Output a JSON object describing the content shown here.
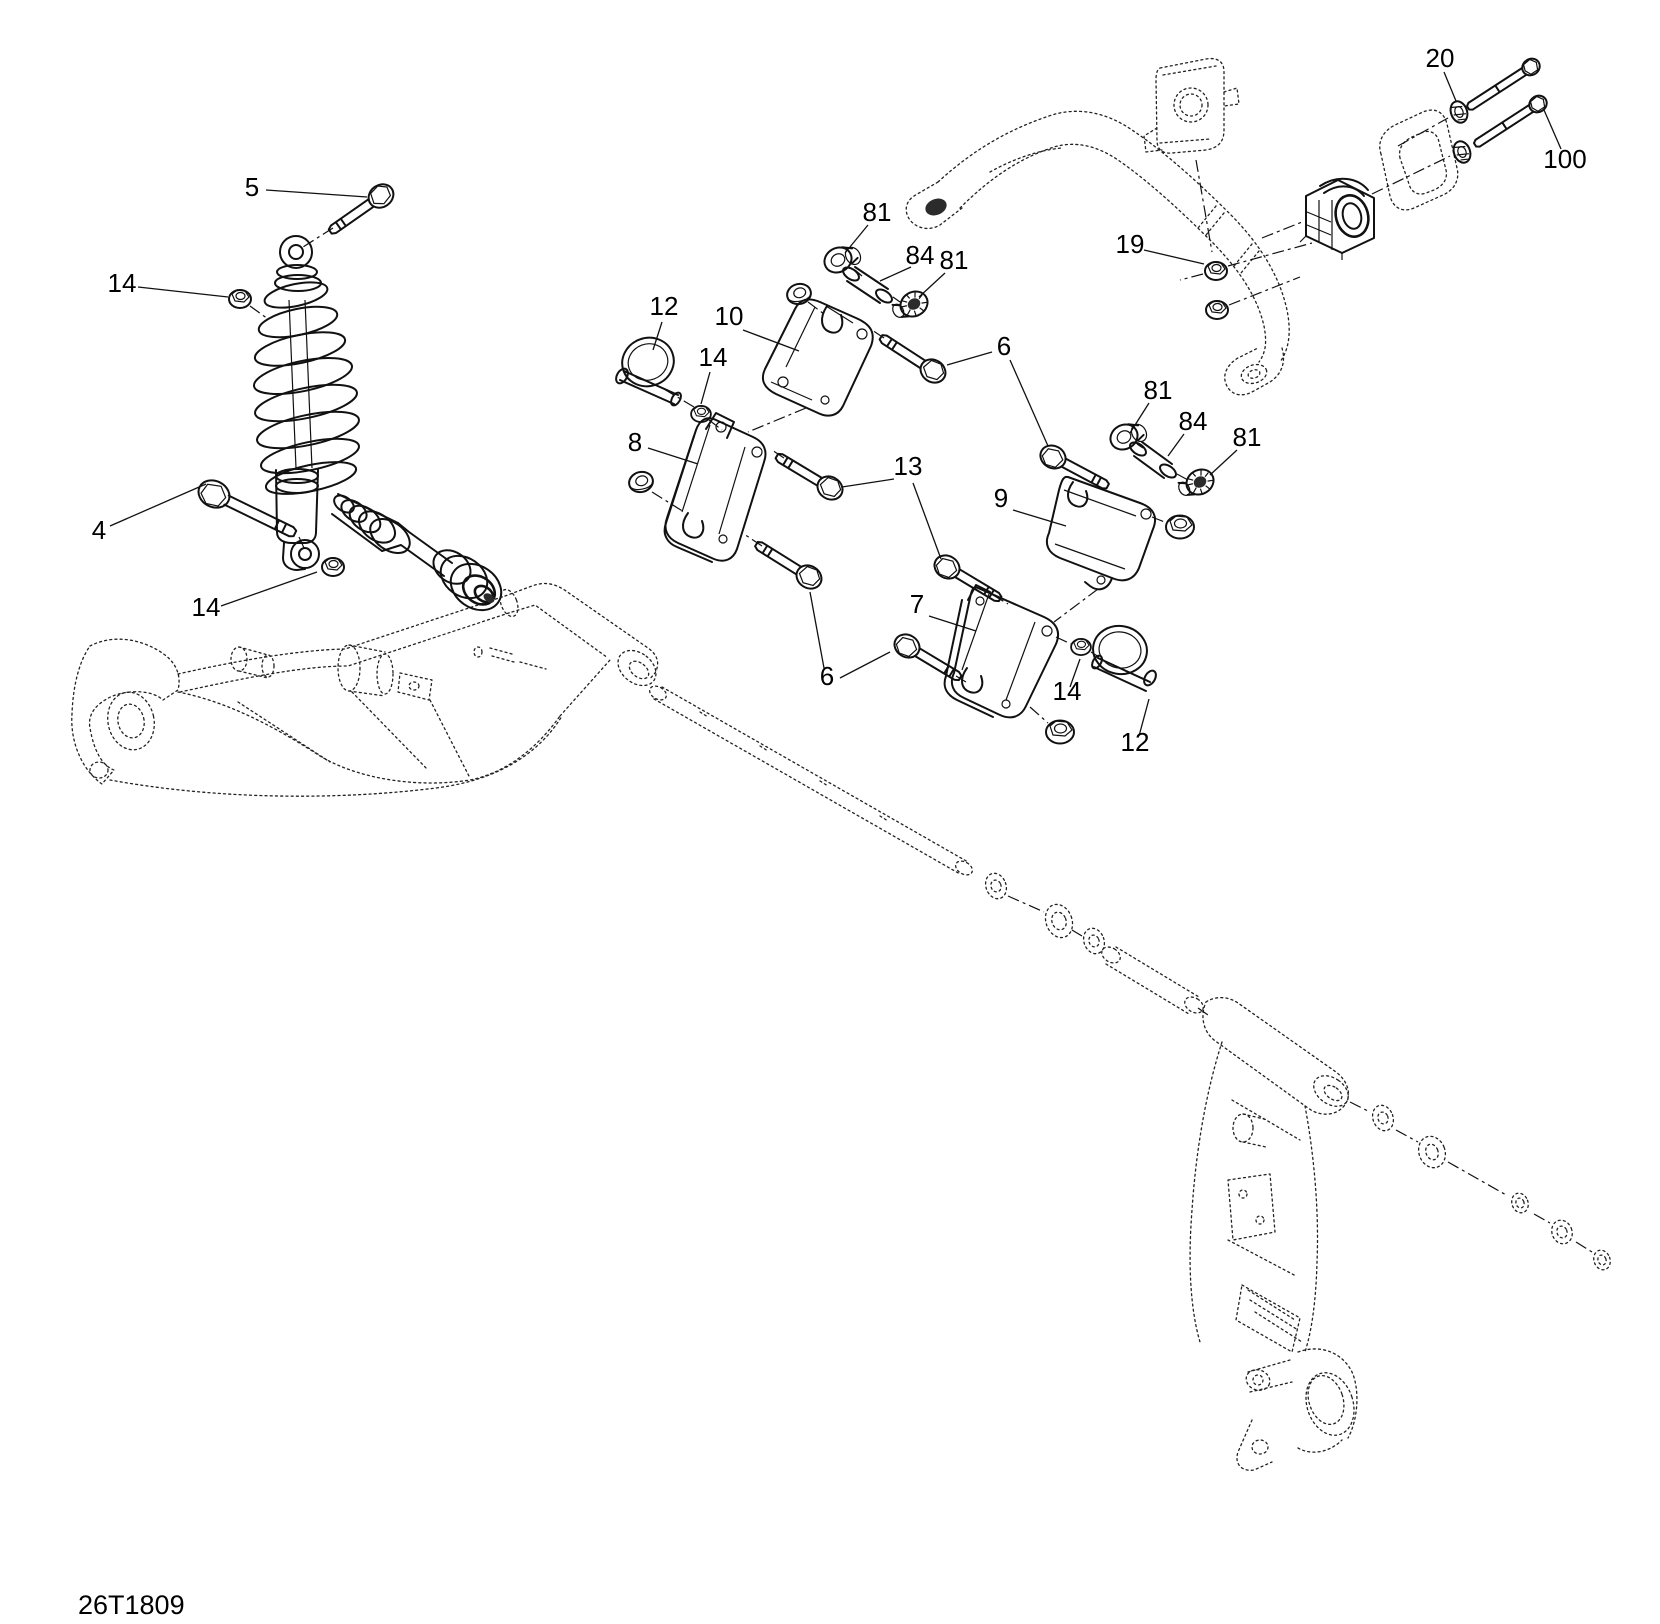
{
  "diagram": {
    "code": "26T1809",
    "type": "exploded-parts-diagram",
    "colors": {
      "line": "#111111",
      "background": "#ffffff"
    },
    "callouts": [
      {
        "label": "5",
        "x": 252,
        "y": 187
      },
      {
        "label": "14",
        "x": 122,
        "y": 283
      },
      {
        "label": "4",
        "x": 99,
        "y": 530
      },
      {
        "label": "14",
        "x": 206,
        "y": 607
      },
      {
        "label": "12",
        "x": 664,
        "y": 306
      },
      {
        "label": "10",
        "x": 729,
        "y": 316
      },
      {
        "label": "14",
        "x": 713,
        "y": 357
      },
      {
        "label": "8",
        "x": 635,
        "y": 442
      },
      {
        "label": "81",
        "x": 877,
        "y": 212
      },
      {
        "label": "84",
        "x": 920,
        "y": 255
      },
      {
        "label": "81",
        "x": 954,
        "y": 260
      },
      {
        "label": "6",
        "x": 1004,
        "y": 346
      },
      {
        "label": "19",
        "x": 1130,
        "y": 244
      },
      {
        "label": "20",
        "x": 1440,
        "y": 58
      },
      {
        "label": "100",
        "x": 1565,
        "y": 159
      },
      {
        "label": "81",
        "x": 1158,
        "y": 390
      },
      {
        "label": "84",
        "x": 1193,
        "y": 421
      },
      {
        "label": "81",
        "x": 1247,
        "y": 437
      },
      {
        "label": "13",
        "x": 908,
        "y": 466
      },
      {
        "label": "9",
        "x": 1001,
        "y": 498
      },
      {
        "label": "7",
        "x": 917,
        "y": 604
      },
      {
        "label": "6",
        "x": 827,
        "y": 676
      },
      {
        "label": "14",
        "x": 1067,
        "y": 691
      },
      {
        "label": "12",
        "x": 1135,
        "y": 742
      }
    ]
  }
}
